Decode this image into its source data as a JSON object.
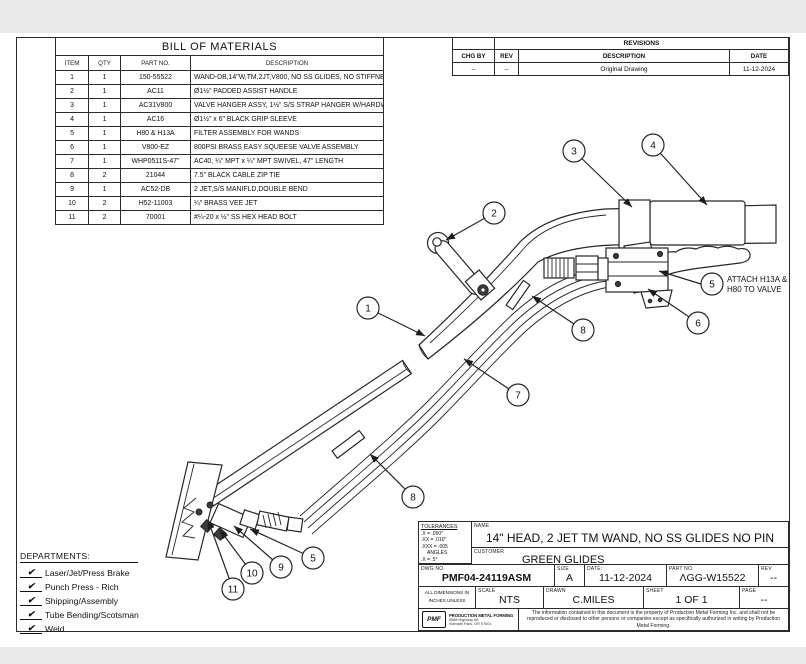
{
  "page": {
    "background": "#e9e9e9",
    "sheet": "#ffffff",
    "line_color": "#262626"
  },
  "bom": {
    "title": "BILL OF MATERIALS",
    "headers": {
      "item": "ITEM",
      "qty": "QTY",
      "part": "PART NO.",
      "desc": "DESCRIPTION"
    },
    "rows": [
      {
        "item": "1",
        "qty": "1",
        "part": "150-55522",
        "desc": "WAND-DB,14\"W,TM,2JT,V800, NO SS GLIDES, NO STIFFNER PIN"
      },
      {
        "item": "2",
        "qty": "1",
        "part": "AC11",
        "desc": "Ø1½\" PADDED ASSIST HANDLE"
      },
      {
        "item": "3",
        "qty": "1",
        "part": "AC31V800",
        "desc": "VALVE HANGER ASSY, 1½\" S/S STRAP HANGER W/HARDWARE"
      },
      {
        "item": "4",
        "qty": "1",
        "part": "AC16",
        "desc": "Ø1½\" x 6\" BLACK GRIP SLEEVE"
      },
      {
        "item": "5",
        "qty": "1",
        "part": "H80 & H13A",
        "desc": "FILTER ASSEMBLY FOR WANDS"
      },
      {
        "item": "6",
        "qty": "1",
        "part": "V800-EZ",
        "desc": "800PSI BRASS EASY SQUEESE VALVE ASSEMBLY"
      },
      {
        "item": "7",
        "qty": "1",
        "part": "WHP0511S-47\"",
        "desc": "AC40, ¼\" MPT x ¼\" MPT SWIVEL, 47\" LENGTH"
      },
      {
        "item": "8",
        "qty": "2",
        "part": "21044",
        "desc": "7.5\" BLACK CABLE ZIP TIE"
      },
      {
        "item": "9",
        "qty": "1",
        "part": "AC52-DB",
        "desc": "2 JET,S/S MANIFLD,DOUBLE BEND"
      },
      {
        "item": "10",
        "qty": "2",
        "part": "H52-11003",
        "desc": "¼\" BRASS VEE JET"
      },
      {
        "item": "11",
        "qty": "2",
        "part": "70001",
        "desc": "#¼-20 x ½\" SS HEX HEAD BOLT"
      }
    ]
  },
  "revisions": {
    "title": "REVISIONS",
    "headers": {
      "chg_by": "CHG BY",
      "rev": "REV",
      "description": "DESCRIPTION",
      "date": "DATE"
    },
    "rows": [
      {
        "chg_by": "--",
        "rev": "--",
        "description": "Original Drawing",
        "date": "11-12-2024"
      }
    ]
  },
  "departments": {
    "title": "DEPARTMENTS:",
    "check": "✔",
    "items": [
      "Laser/Jet/Press Brake",
      "Punch Press - Rich",
      "Shipping/Assembly",
      "Tube Bending/Scotsman",
      "Weld"
    ]
  },
  "diagram": {
    "balloons": [
      {
        "label": "1"
      },
      {
        "label": "2"
      },
      {
        "label": "3"
      },
      {
        "label": "4"
      },
      {
        "label": "5"
      },
      {
        "label": "6"
      },
      {
        "label": "7"
      },
      {
        "label": "8"
      },
      {
        "label": "8"
      },
      {
        "label": "5"
      },
      {
        "label": "9"
      },
      {
        "label": "10"
      },
      {
        "label": "11"
      }
    ],
    "note_line1": "ATTACH H13A &",
    "note_line2": "H80 TO VALVE"
  },
  "title_block": {
    "tolerances": {
      "title": "TOLERANCES",
      "lines": [
        ".X = .050\"",
        ".XX = .010\"",
        ".XXX = .005",
        "ANGLES",
        ".X = .5°"
      ]
    },
    "name_label": "NAME",
    "name_value": "14\" HEAD, 2 JET TM WAND, NO SS GLIDES NO PIN",
    "customer_label": "CUSTOMER",
    "customer_value": "GREEN GLIDES",
    "dwg_label": "DWG NO.",
    "dwg_value": "PMF04-24119ASM",
    "size_label": "SIZE",
    "size_value": "A",
    "date_label": "DATE:",
    "date_value": "11-12-2024",
    "part_label": "PART NO.",
    "part_value": "ΛGG-W15522",
    "rev_label": "REV",
    "rev_value": "--",
    "dims_lines": [
      "ALL DIMENSIONS IN",
      "INCHES UNLESS",
      "OTHERWISE NOTED"
    ],
    "scale_label": "SCALE",
    "scale_value": "NTS",
    "drawn_label": "DRAWN",
    "drawn_value": "C.MILES",
    "sheet_label": "SHEET",
    "sheet_value": "1 OF 1",
    "page_label": "PAGE",
    "page_value": "--",
    "logo_text": "PMF",
    "company": "PRODUCTION METAL FORMING",
    "address1": "8988 Highway 66",
    "address2": "Klamath Falls, OR 97601",
    "legal": "The information contained in this document is the property of Production Metal Forming Inc. and shall not be reproduced or disclosed to other persons or companies except as specifically authorized in writing by Production Metal  Forming."
  }
}
